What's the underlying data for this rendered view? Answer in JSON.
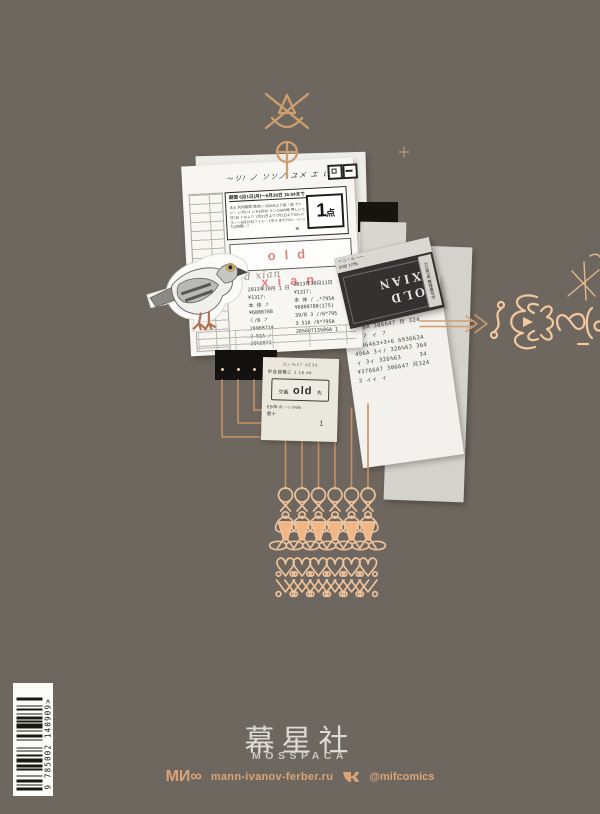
{
  "page": {
    "background": "#6e675f"
  },
  "colors": {
    "ornament_dark": "#cf9e6f",
    "ornament_light": "#f3c89d",
    "circuit_line": "#c79263",
    "accent_pink": "#e0837b",
    "footer_accent": "#d9a477",
    "brand_gray": "#dcdbd6",
    "paper_white": "#f7f6f2",
    "ticket_dark": "#343230"
  },
  "collage": {
    "main_paper": {
      "scribble": "〜リ! ノ ソソノ ユメ エ い",
      "period_label": "期間 6月1日(月)〜6月30日 16:04まで",
      "notice_lines": "本土 利用期間 提供い 9月6日より版・様 アトレ・ い月い1 いち6月30 ランの600時 押しい 5月7日 トなレり 1月31日より7月1日より53レ0ラ――6月16日 7 トレ・1号 6 まの7%レ・いっち()時間・7",
      "equals_mark": "≡",
      "points_value": "1",
      "points_unit": "点",
      "title": "old  xian",
      "signature": "old xian",
      "receipt_col1": [
        "2013年10月 1 日",
        "¥1317:",
        "本 体 ㇇",
        "¥6888788",
        "ㄑ/B ㇇",
        "2896871A",
        "3 51A /",
        "26%6871"
      ],
      "receipt_col2": [
        "2013年10月11日",
        "¥1317:",
        "本 体 / ,*795A",
        "¥6888788(175)",
        "39/B 3 //6*795",
        "3 51A /6*795A",
        "26%68713%86A 1"
      ]
    },
    "right_receipt": {
      "lines": [
        "ィ ㇇ ィ ィ",
        "¥6264 296%63 月  57A",
        "+3 ィ ィ         324",
        "¥636A 306647 月 324",
        "ㄑ ㇇ ィ ㇇",
        "-696463+3+6 693662A",
        "496A 3ィ/ 326%63 364",
        "ィ 3ィ 326%63     34",
        "¥3766A7 306647 月324",
        "3 ィィ ィ"
      ]
    },
    "dark_ticket": {
      "header_line1": "ー ニ・ム ——",
      "header_line2": "|#38'  1/7B)",
      "side_text": "112用2用 整理番号付",
      "main_text": "OLD XIAN"
    },
    "bottom_receipt": {
      "line1": "G)-%27 4E36",
      "line2": "甲各疑難に 1 16 ##",
      "box_cjk_left": "交番",
      "box_main": "old",
      "box_cjk_right": "先",
      "line3": "E5/年 /h ・/- I%%",
      "line4": "雲十",
      "number": "1"
    }
  },
  "footer": {
    "brand_cjk": "幕星社",
    "brand_latin": "MOSSPACA",
    "mif_logo": "МИ∞",
    "publisher_url": "mann-ivanov-ferber.ru",
    "social_handle": "@mifcomics"
  },
  "barcode": {
    "number_text": "9 785002 140909>"
  }
}
